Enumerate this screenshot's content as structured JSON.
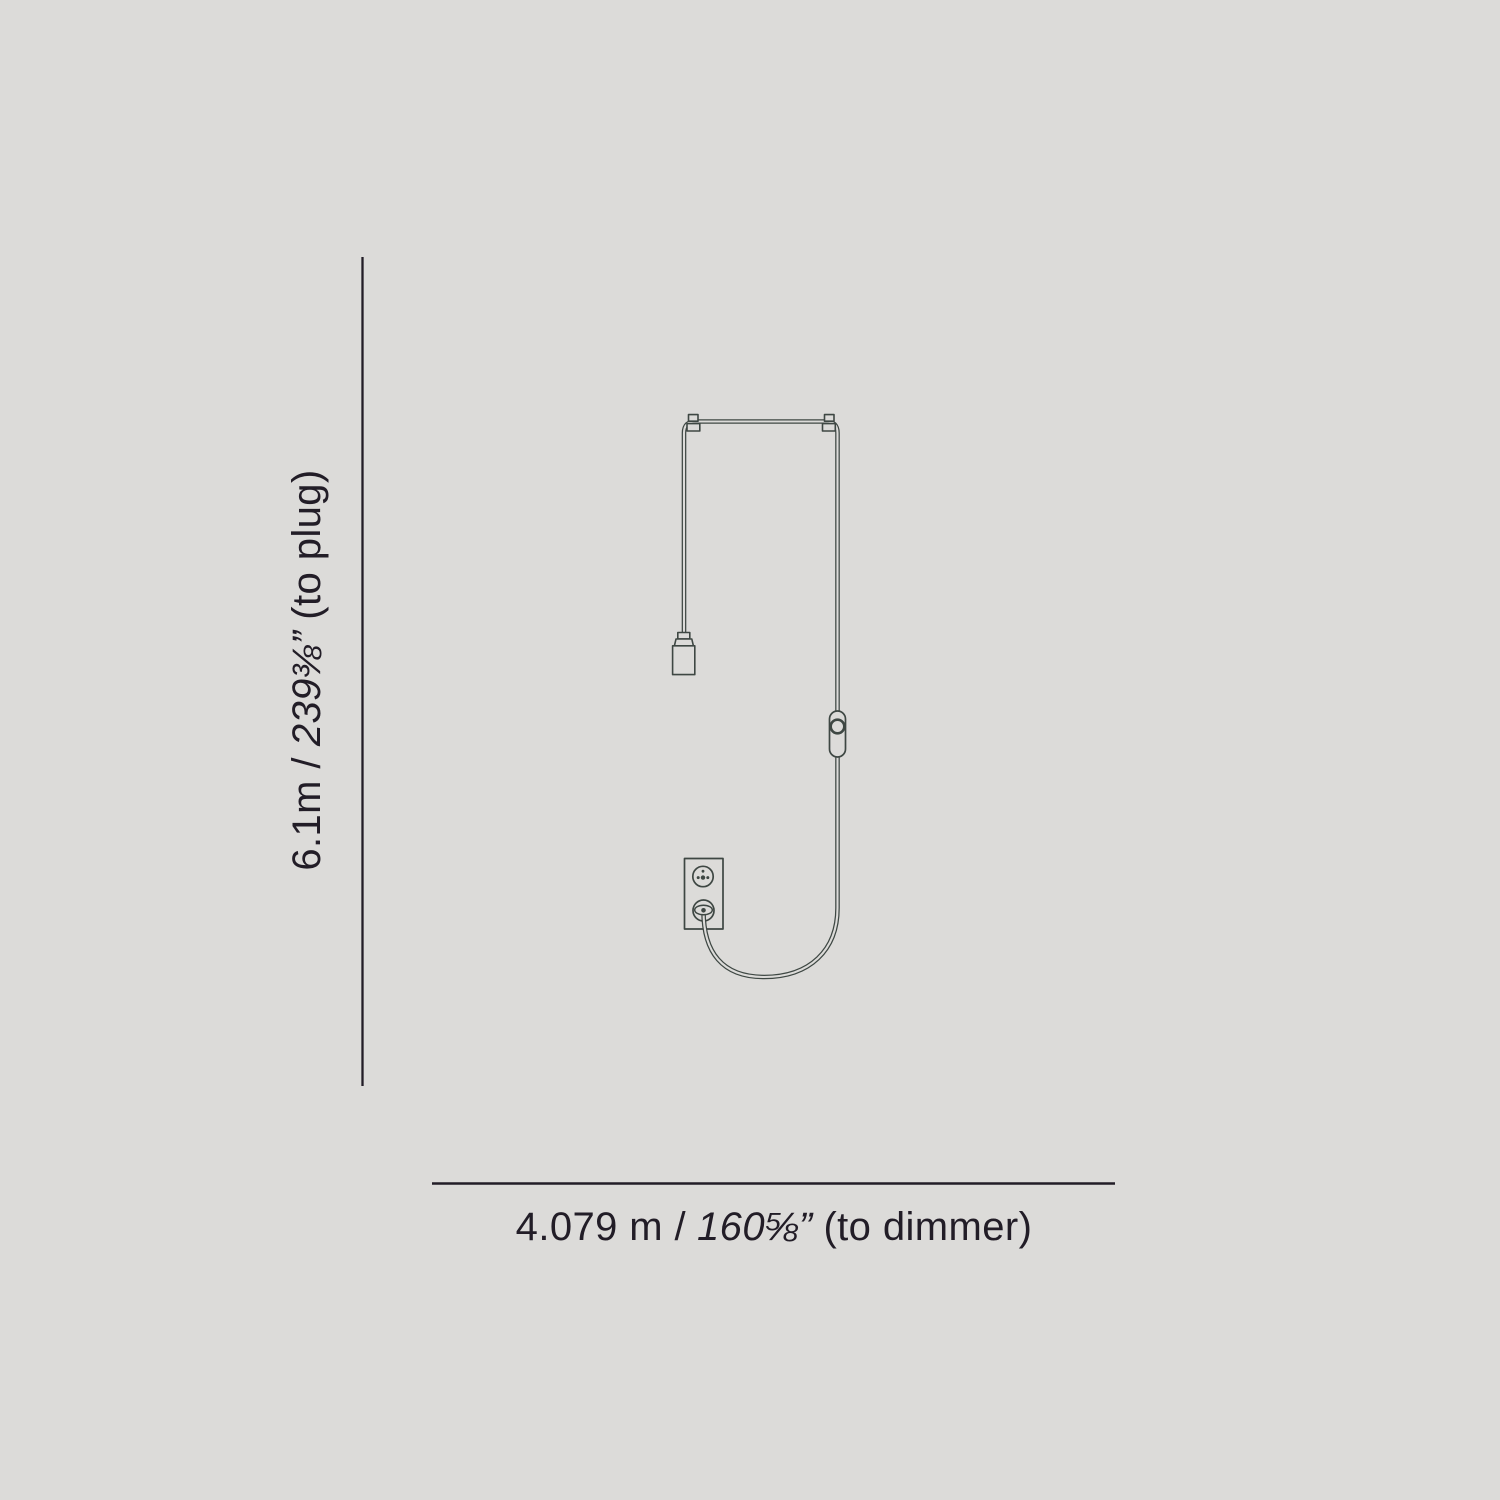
{
  "colors": {
    "background": "#dcdbd9",
    "line": "#3e4743",
    "dimension": "#221d27"
  },
  "dimensions": {
    "vertical": {
      "metric": "6.1m /",
      "imperial": "239⅜”",
      "note": "(to plug)"
    },
    "horizontal": {
      "metric": "4.079 m /",
      "imperial": "160⅝”",
      "note": "(to dimmer)"
    }
  },
  "diagram": {
    "subject": "wall-lamp-with-cord-dimmer-and-plug",
    "parts": [
      "suspension-bar",
      "wall-clips",
      "lamp-socket",
      "power-cord",
      "inline-dimmer",
      "wall-outlet",
      "plug"
    ]
  }
}
